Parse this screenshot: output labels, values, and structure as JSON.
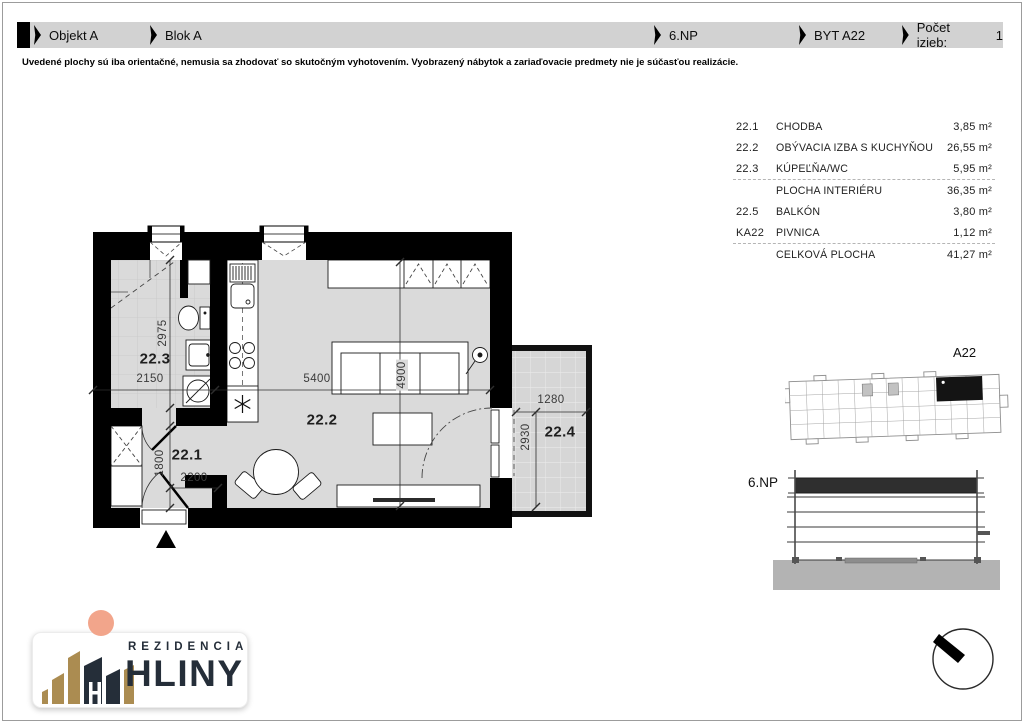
{
  "header": {
    "segments": [
      {
        "label": "Objekt A"
      },
      {
        "label": "Blok A"
      },
      {
        "label": "6.NP"
      },
      {
        "label": "BYT A22"
      },
      {
        "label": "Počet izieb:"
      }
    ],
    "room_count": "1"
  },
  "disclaimer": "Uvedené plochy sú iba orientačné, nemusia sa zhodovať so skutočným vyhotovením. Vyobrazený nábytok a zariaďovacie predmety nie je súčasťou realizácie.",
  "area_table": {
    "rows": [
      {
        "code": "22.1",
        "name": "CHODBA",
        "area": "3,85 m²"
      },
      {
        "code": "22.2",
        "name": "OBÝVACIA IZBA S KUCHYŇOU",
        "area": "26,55 m²"
      },
      {
        "code": "22.3",
        "name": "KÚPEĽŇA/WC",
        "area": "5,95 m²"
      },
      {
        "code": "",
        "name": "PLOCHA INTERIÉRU",
        "area": "36,35 m²"
      },
      {
        "code": "22.5",
        "name": "BALKÓN",
        "area": "3,80 m²"
      },
      {
        "code": "KA22",
        "name": "PIVNICA",
        "area": "1,12 m²"
      },
      {
        "code": "",
        "name": "CELKOVÁ PLOCHA",
        "area": "41,27 m²"
      }
    ]
  },
  "plan": {
    "room_labels": {
      "hall": "22.1",
      "living": "22.2",
      "bath": "22.3",
      "balcony": "22.4"
    },
    "dimensions": {
      "bath_width": "2150",
      "bath_depth": "2975",
      "living_width": "5400",
      "living_depth": "4900",
      "hall_width": "2200",
      "hall_depth": "1800",
      "balcony_width": "1280",
      "balcony_depth": "2930"
    }
  },
  "keyplan": {
    "unit_label": "A22"
  },
  "section": {
    "floor_label": "6.NP"
  },
  "logo": {
    "line1": "REZIDENCIA",
    "line2": "HLINY"
  },
  "colors": {
    "header_bar": "#d2d2d2",
    "wall": "#000000",
    "floor": "#dadada",
    "unit_highlight": "#141414",
    "section_highlight": "#2f2f2f",
    "ground": "#b3b3b3",
    "logo_gold": "#ab8c51",
    "logo_navy": "#252e39",
    "logo_peach": "#f2a58b"
  }
}
